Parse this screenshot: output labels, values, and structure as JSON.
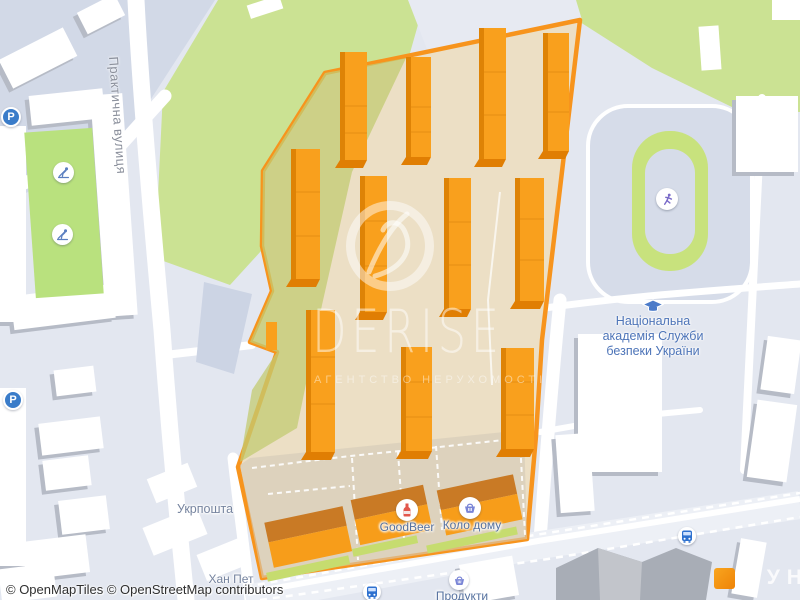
{
  "street": {
    "name": "Практична вулиця"
  },
  "pois": {
    "ukrposhta": "Укрпошта",
    "khan_pet": "Хан Пет",
    "goodbeer": "GoodBeer",
    "kolo_domu": "Коло дому",
    "produkty": "Продукти"
  },
  "academy": {
    "lines": [
      "Національна",
      "академія Служби",
      "безпеки України"
    ]
  },
  "watermark": {
    "brand": "DERISE",
    "subtitle": "АГЕНТСТВО НЕРУХОМОСТІ"
  },
  "vendor_logo": {
    "text": "ЛУН"
  },
  "attribution": {
    "text": "© OpenMapTiles © OpenStreetMap contributors"
  },
  "icons": {
    "parking_letter": "P",
    "parking": "P-in-blue-circle",
    "playground": "child-on-slide",
    "running_track": "runner",
    "academy": "graduation-cap",
    "bus_stop": "bus-front",
    "beer_shop": "bottle",
    "grocery": "shopping-basket"
  },
  "colors": {
    "estate_accent": "#F7941D",
    "estate_fill": "#ECDFC5",
    "park_green": "#CBE293",
    "courtyard_green": "#B9E17E",
    "stadium_green": "#C8E27D",
    "map_background": "#E3E7F0",
    "academy_label": "#4D74B8",
    "poi_label": "#55719F",
    "street_label": "#8B909C",
    "attribution_text": "#2F2F2F"
  }
}
